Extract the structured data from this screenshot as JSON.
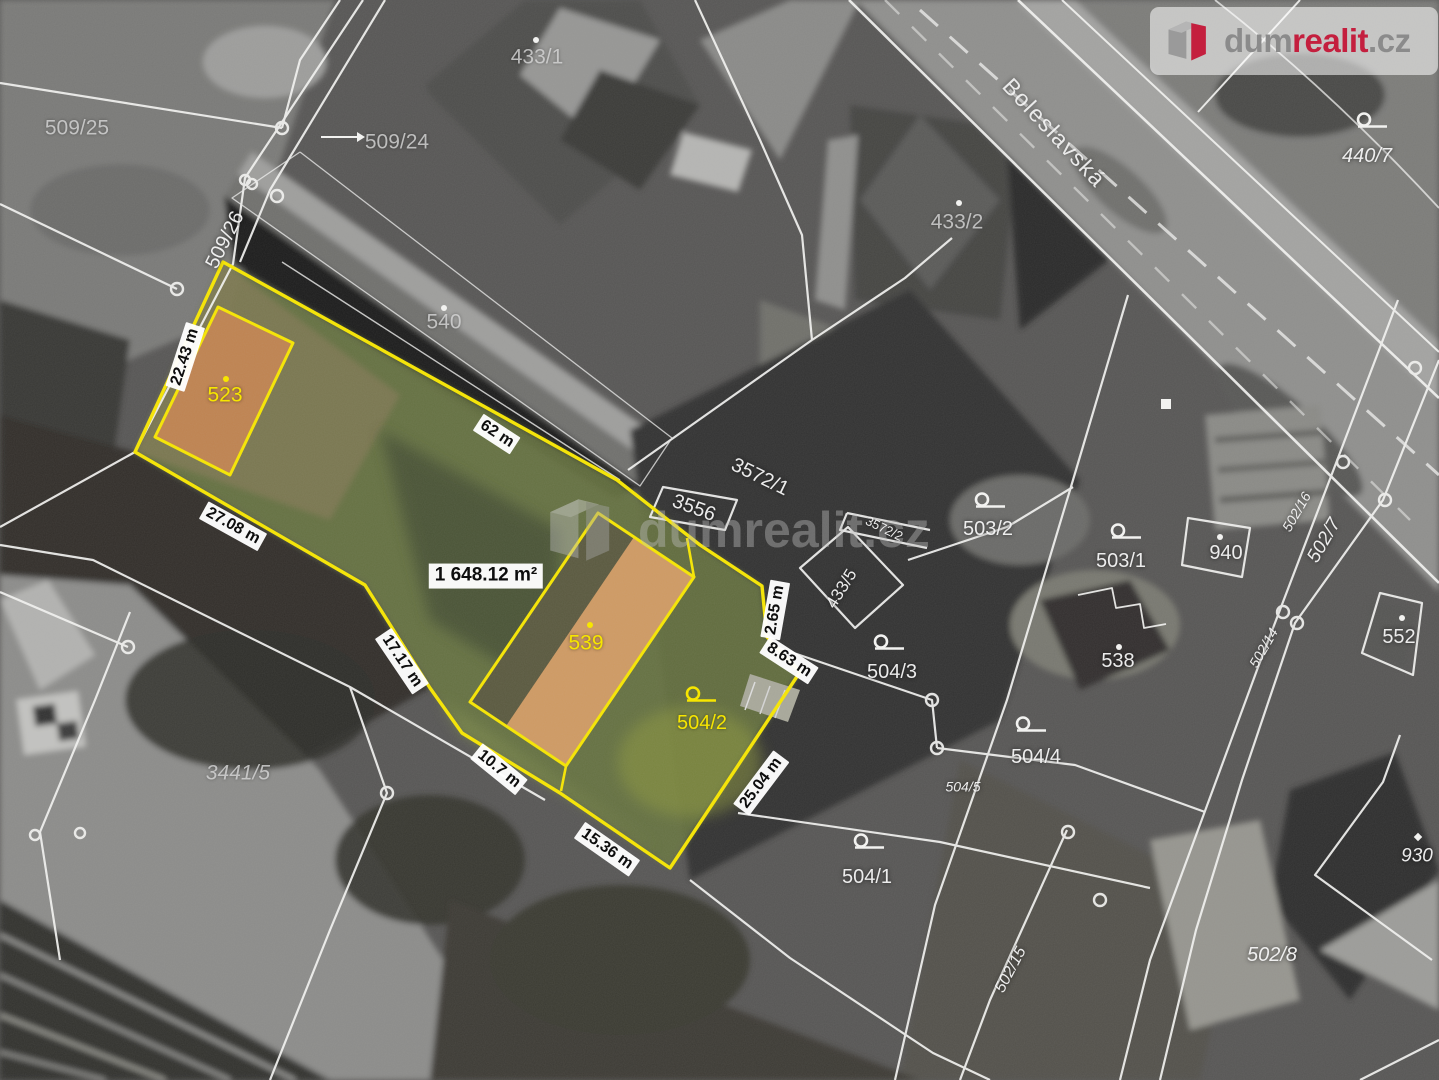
{
  "brand": {
    "prefix": "dum",
    "highlight": "realit",
    "suffix": ".cz",
    "red": "#c41f3e",
    "gray": "#8b8b8b"
  },
  "watermark": {
    "prefix": "dum",
    "highlight": "realit",
    "suffix": ".cz"
  },
  "street": {
    "name": "Boleslavská"
  },
  "highlight_parcel": {
    "area_label": "1 648.12 m²",
    "border_color": "#f7e600",
    "building_numbers": [
      "523",
      "539"
    ],
    "garden_number": "504/2",
    "edge_lengths": [
      "22.43 m",
      "62 m",
      "27.08 m",
      "17.17 m",
      "10.7 m",
      "15.36 m",
      "25.04 m",
      "2.65 m",
      "8.63 m"
    ]
  },
  "map_labels": [
    {
      "name": "parcel-label-509-25",
      "text": "509/25",
      "x": 77,
      "y": 128,
      "cls": "gray"
    },
    {
      "name": "parcel-label-509-24",
      "text": "509/24",
      "x": 397,
      "y": 142,
      "cls": "gray"
    },
    {
      "name": "parcel-label-509-26",
      "text": "509/26",
      "x": 225,
      "y": 240,
      "rot": -63,
      "cls": "white"
    },
    {
      "name": "parcel-label-433-1",
      "text": "433/1",
      "x": 537,
      "y": 57,
      "cls": "gray"
    },
    {
      "name": "building-label-540",
      "text": "540",
      "x": 444,
      "y": 322,
      "cls": "gray"
    },
    {
      "name": "parcel-label-433-2",
      "text": "433/2",
      "x": 957,
      "y": 222,
      "cls": "gray"
    },
    {
      "name": "parcel-label-440-7",
      "text": "440/7",
      "x": 1367,
      "y": 156,
      "cls": "white italic"
    },
    {
      "name": "street-label-boleslavska",
      "text": "Boleslavská",
      "x": 1054,
      "y": 133,
      "rot": 47,
      "cls": "street"
    },
    {
      "name": "parcel-label-3556",
      "text": "3556",
      "x": 694,
      "y": 508,
      "rot": 20,
      "cls": "white"
    },
    {
      "name": "parcel-label-3572-1",
      "text": "3572/1",
      "x": 760,
      "y": 477,
      "rot": 26,
      "cls": "white"
    },
    {
      "name": "parcel-label-3572-2",
      "text": "3572/2",
      "x": 884,
      "y": 529,
      "rot": 26,
      "cls": "white",
      "size": 13
    },
    {
      "name": "parcel-label-433-5",
      "text": "433/5",
      "x": 842,
      "y": 589,
      "rot": -58,
      "cls": "white",
      "size": 17
    },
    {
      "name": "parcel-label-503-2",
      "text": "503/2",
      "x": 988,
      "y": 529,
      "cls": "white"
    },
    {
      "name": "parcel-label-503-1",
      "text": "503/1",
      "x": 1121,
      "y": 561,
      "cls": "white"
    },
    {
      "name": "building-label-940",
      "text": "940",
      "x": 1226,
      "y": 553,
      "cls": "white"
    },
    {
      "name": "building-label-538",
      "text": "538",
      "x": 1118,
      "y": 661,
      "cls": "white"
    },
    {
      "name": "building-label-552",
      "text": "552",
      "x": 1399,
      "y": 637,
      "cls": "white"
    },
    {
      "name": "parcel-label-502-16",
      "text": "502/16",
      "x": 1297,
      "y": 512,
      "rot": -60,
      "cls": "white italic",
      "size": 14
    },
    {
      "name": "parcel-label-502-7",
      "text": "502/7",
      "x": 1325,
      "y": 541,
      "rot": -60,
      "cls": "white italic",
      "size": 19
    },
    {
      "name": "parcel-label-502-14",
      "text": "502/14",
      "x": 1264,
      "y": 648,
      "rot": -60,
      "cls": "white italic",
      "size": 14
    },
    {
      "name": "parcel-label-504-3",
      "text": "504/3",
      "x": 892,
      "y": 672,
      "cls": "white"
    },
    {
      "name": "parcel-label-504-4",
      "text": "504/4",
      "x": 1036,
      "y": 757,
      "cls": "white"
    },
    {
      "name": "parcel-label-504-5",
      "text": "504/5",
      "x": 963,
      "y": 787,
      "cls": "white italic",
      "size": 14
    },
    {
      "name": "parcel-label-504-1",
      "text": "504/1",
      "x": 867,
      "y": 877,
      "cls": "white"
    },
    {
      "name": "parcel-label-3441-5",
      "text": "3441/5",
      "x": 238,
      "y": 773,
      "cls": "gray italic"
    },
    {
      "name": "parcel-label-502-15",
      "text": "502/15",
      "x": 1011,
      "y": 970,
      "rot": -62,
      "cls": "white italic",
      "size": 16
    },
    {
      "name": "parcel-label-502-8",
      "text": "502/8",
      "x": 1272,
      "y": 955,
      "cls": "white italic"
    },
    {
      "name": "building-label-930",
      "text": "930",
      "x": 1417,
      "y": 857,
      "cls": "white italic",
      "size": 19
    },
    {
      "name": "building-label-523",
      "text": "523",
      "x": 225,
      "y": 395,
      "cls": "yellow"
    },
    {
      "name": "building-label-539",
      "text": "539",
      "x": 586,
      "y": 643,
      "cls": "yellow"
    },
    {
      "name": "parcel-label-504-2",
      "text": "504/2",
      "x": 702,
      "y": 723,
      "cls": "yellow",
      "size": 20
    },
    {
      "name": "measure-22-43",
      "text": "22.43 m",
      "x": 185,
      "y": 357,
      "rot": -72,
      "cls": "measure"
    },
    {
      "name": "measure-62",
      "text": "62 m",
      "x": 497,
      "y": 434,
      "rot": 33,
      "cls": "measure"
    },
    {
      "name": "measure-27-08",
      "text": "27.08 m",
      "x": 233,
      "y": 526,
      "rot": 29,
      "cls": "measure"
    },
    {
      "name": "measure-17-17",
      "text": "17.17 m",
      "x": 402,
      "y": 661,
      "rot": 56,
      "cls": "measure"
    },
    {
      "name": "measure-10-7",
      "text": "10.7 m",
      "x": 499,
      "y": 769,
      "rot": 39,
      "cls": "measure"
    },
    {
      "name": "measure-15-36",
      "text": "15.36 m",
      "x": 607,
      "y": 849,
      "rot": 35,
      "cls": "measure"
    },
    {
      "name": "measure-25-04",
      "text": "25.04 m",
      "x": 761,
      "y": 783,
      "rot": -53,
      "cls": "measure"
    },
    {
      "name": "measure-2-65",
      "text": "2.65 m",
      "x": 775,
      "y": 610,
      "rot": -80,
      "cls": "measure"
    },
    {
      "name": "measure-8-63",
      "text": "8.63 m",
      "x": 789,
      "y": 660,
      "rot": 33,
      "cls": "measure"
    },
    {
      "name": "area-label",
      "text": "1 648.12 m²",
      "x": 486,
      "y": 576,
      "cls": "area"
    }
  ],
  "symbols": [
    {
      "type": "loop",
      "x": 1372,
      "y": 125
    },
    {
      "type": "loop",
      "x": 990,
      "y": 505
    },
    {
      "type": "loop",
      "x": 1126,
      "y": 536
    },
    {
      "type": "loop",
      "x": 889,
      "y": 647
    },
    {
      "type": "loop",
      "x": 1031,
      "y": 729
    },
    {
      "type": "loop",
      "x": 869,
      "y": 846
    },
    {
      "type": "loop",
      "x": 701,
      "y": 699,
      "color": "#f7e600"
    },
    {
      "type": "dot",
      "x": 444,
      "y": 308
    },
    {
      "type": "dot",
      "x": 959,
      "y": 203
    },
    {
      "type": "dot",
      "x": 536,
      "y": 40
    },
    {
      "type": "dot",
      "x": 1220,
      "y": 537
    },
    {
      "type": "dot",
      "x": 1119,
      "y": 647
    },
    {
      "type": "dot",
      "x": 1402,
      "y": 618
    },
    {
      "type": "diamond",
      "x": 1418,
      "y": 838
    },
    {
      "type": "square",
      "x": 1166,
      "y": 405
    },
    {
      "type": "dot",
      "x": 226,
      "y": 379,
      "color": "#f7e600"
    },
    {
      "type": "dot",
      "x": 590,
      "y": 625,
      "color": "#f7e600"
    },
    {
      "type": "arrow",
      "x": 343,
      "y": 139
    }
  ]
}
